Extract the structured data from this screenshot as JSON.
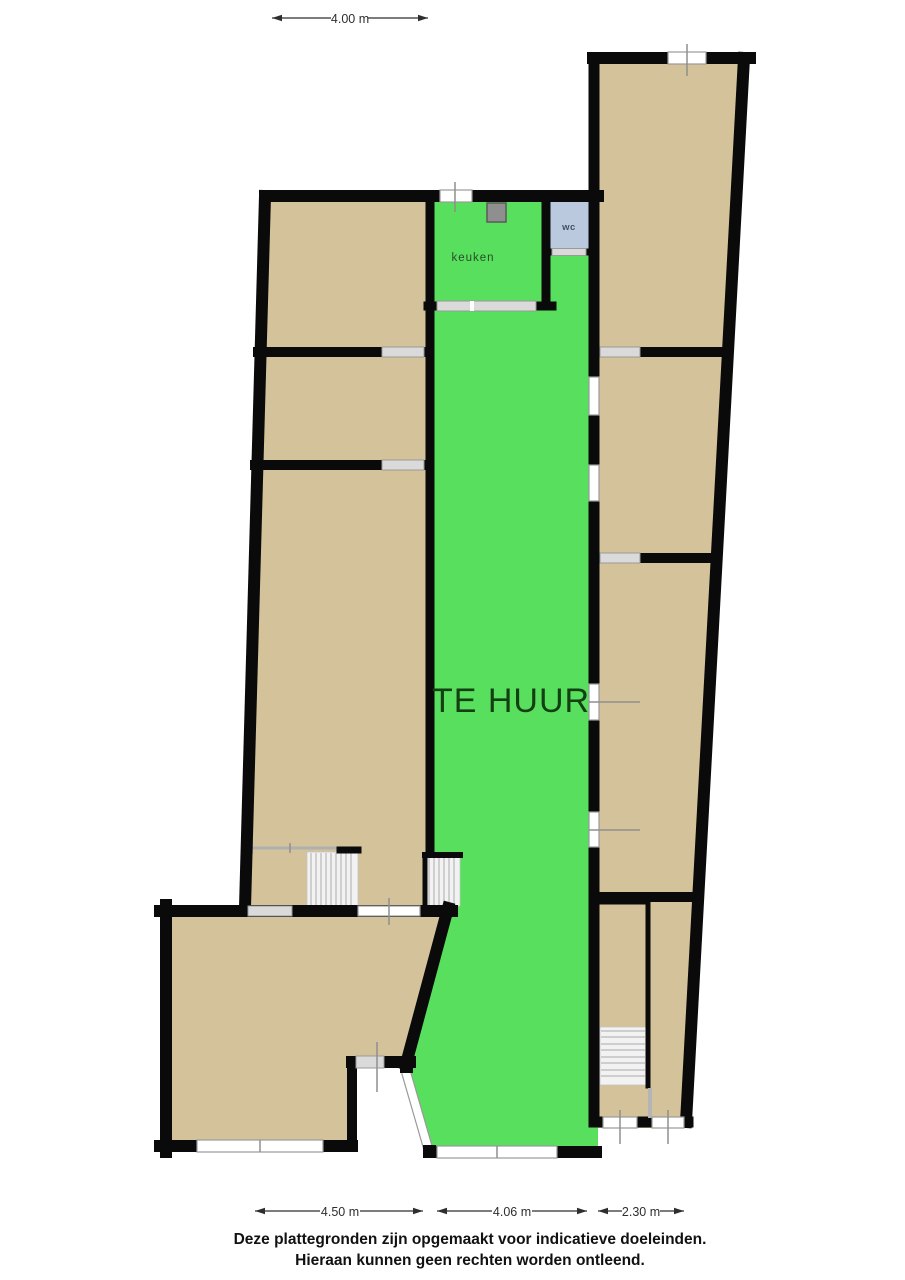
{
  "plan": {
    "labels": {
      "unit": "TE HUUR",
      "kitchen": "keuken",
      "toilet": "wc"
    },
    "dimensions": {
      "top": "4.00 m",
      "bottom_left": "4.50 m",
      "bottom_middle": "4.06 m",
      "bottom_right": "2.30 m"
    },
    "disclaimer": {
      "line1": "Deze plattegronden zijn opgemaakt voor indicatieve doeleinden.",
      "line2": "Hieraan kunnen geen rechten worden ontleend."
    },
    "colors": {
      "available": "#57df5d",
      "floor": "#d4c29a",
      "toilet_room": "#bac9dd",
      "wall": "#0a0a0a"
    }
  }
}
